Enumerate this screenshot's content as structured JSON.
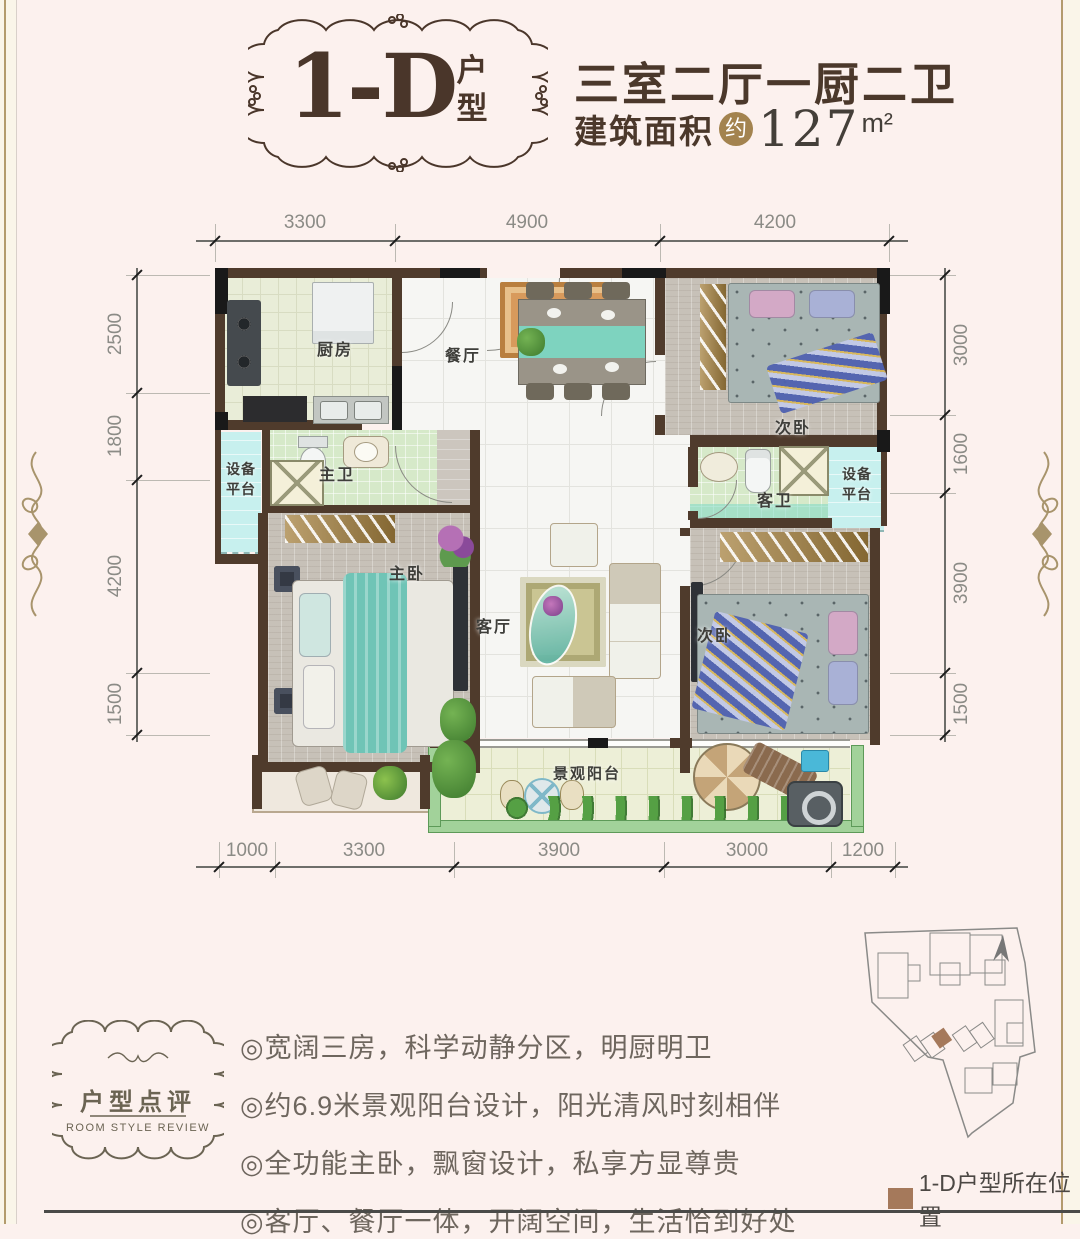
{
  "header": {
    "unit_code": "1-D",
    "unit_type_label_1": "户",
    "unit_type_label_2": "型",
    "headline": "三室二厅一厨二卫",
    "area_label": "建筑面积",
    "area_approx_badge": "约",
    "area_value": "127",
    "area_unit": "m²"
  },
  "dimensions": {
    "top": [
      "3300",
      "4900",
      "4200"
    ],
    "left": [
      "2500",
      "1800",
      "4200",
      "1500"
    ],
    "right": [
      "3000",
      "1600",
      "3900",
      "1500"
    ],
    "bottom": [
      "1000",
      "3300",
      "3900",
      "3000",
      "1200"
    ]
  },
  "rooms": {
    "kitchen": "厨房",
    "dining": "餐厅",
    "bedroom_top_right": "次卧",
    "master_bath": "主卫",
    "equipment_line1": "设备",
    "equipment_line2": "平台",
    "master_bedroom": "主卧",
    "living": "客厅",
    "guest_bath": "客卫",
    "bedroom_bottom_right": "次卧",
    "balcony": "景观阳台"
  },
  "review": {
    "badge_title": "户型点评",
    "badge_subtitle": "ROOM STYLE REVIEW",
    "bullets": [
      "◎宽阔三房，科学动静分区，明厨明卫",
      "◎约6.9米景观阳台设计，阳光清风时刻相伴",
      "◎全功能主卧，飘窗设计，私享方显尊贵",
      "◎客厅、餐厅一体，开阔空间，生活恰到好处"
    ]
  },
  "sitemap": {
    "legend_label": "1-D户型所在位置",
    "marker_color": "#a5795b"
  },
  "colors": {
    "accent_brown": "#4a362a",
    "badge_gold": "#a3834f",
    "wall_brown": "#4f3b2c",
    "equipment_cyan": "#c7f0ee",
    "balcony_green": "#a2d29a",
    "teal": "#7fd4c2"
  }
}
